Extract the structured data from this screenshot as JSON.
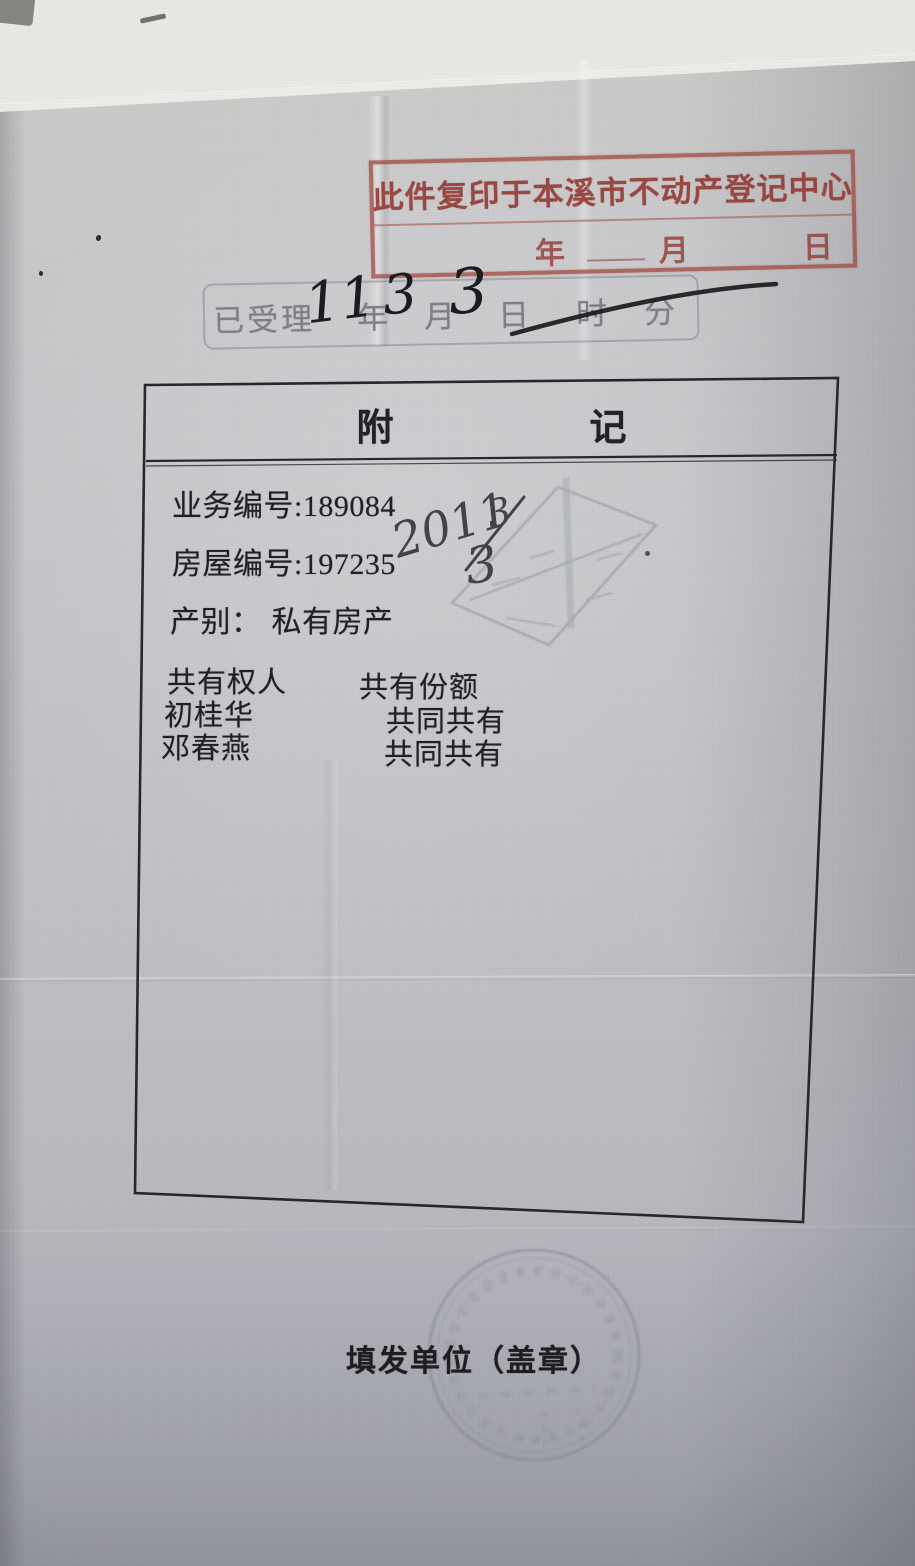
{
  "copy_stamp": {
    "text": "此件复印于本溪市不动产登记中心",
    "year_label": "年",
    "month_label": "月",
    "day_label": "日",
    "color": "#9e433a"
  },
  "received_stamp": {
    "title": "已受理",
    "year_label": "年",
    "month_label": "月",
    "day_label": "日",
    "hour_label": "时",
    "minute_label": "分",
    "handwritten": {
      "year": "11",
      "month": "3",
      "day": "3"
    },
    "stamp_color": "#80808c",
    "ink_color": "#1b1b20"
  },
  "annex_table": {
    "title_char_1": "附",
    "title_char_2": "记",
    "fields": [
      {
        "label": "业务编号:",
        "value": "189084"
      },
      {
        "label": "房屋编号:",
        "value": "197235"
      },
      {
        "label": "产别：",
        "value": "私有房产"
      }
    ],
    "co_owner_section": {
      "name_header": "共有权人",
      "share_header": "共有份额",
      "rows": [
        {
          "name": "初桂华",
          "share": "共同共有"
        },
        {
          "name": "邓春燕",
          "share": "共同共有"
        }
      ]
    }
  },
  "handwriting_note": {
    "year": "2011",
    "numerator": "3",
    "denominator": "3"
  },
  "footer": {
    "issuer_label": "填发单位（盖章）"
  }
}
